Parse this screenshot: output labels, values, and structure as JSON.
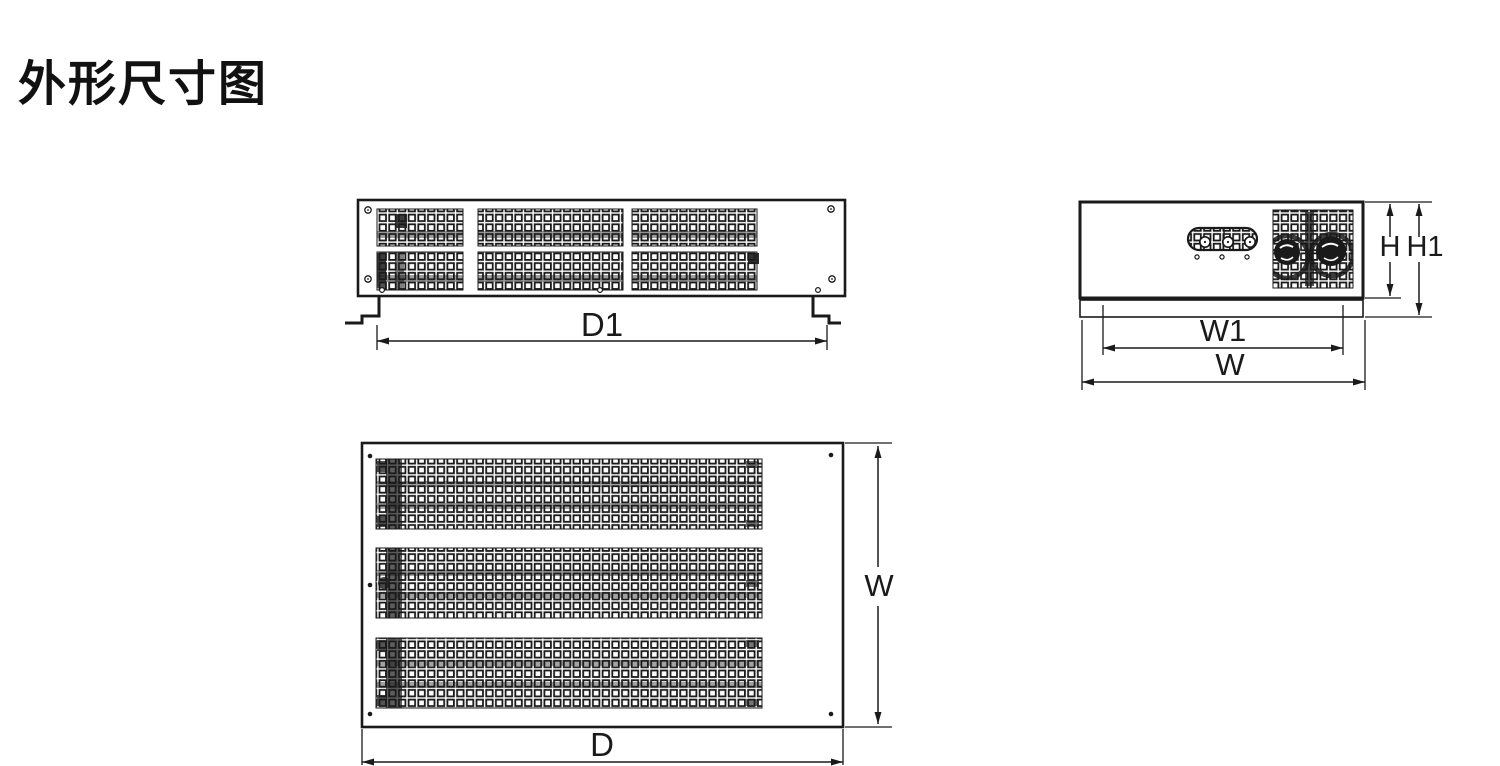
{
  "title": "外形尺寸图",
  "labels": {
    "d1": "D1",
    "h": "H",
    "h1": "H1",
    "w1": "W1",
    "w_side": "W",
    "w_top": "W",
    "d": "D"
  },
  "colors": {
    "line": "#1a1a1a",
    "background": "#ffffff"
  }
}
